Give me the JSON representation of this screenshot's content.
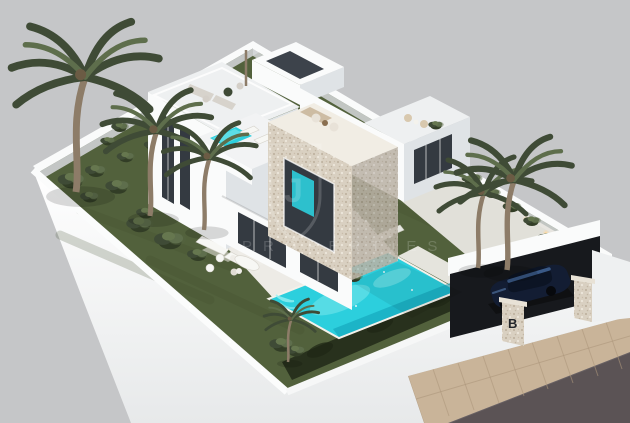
{
  "meta": {
    "image_type": "3D architectural rendering",
    "subject": "Aerial isometric view of a modern two-storey white villa with roof terraces, plunge pool, landscaped garden, turquoise swimming pool, palm trees and a carport with parked car on a floating walled plot",
    "background": "#c5c6c8"
  },
  "watermark": {
    "brand_text": "PROPERTIES",
    "monogram": "J"
  },
  "entrance": {
    "pillar_logo": "B"
  },
  "palette": {
    "bg": "#c5c6c8",
    "lawn": "#52613c",
    "lawnShade": "#3f4c2e",
    "hedge": "#28311d",
    "terrace": "#edebe6",
    "wallBright": "#fafbfb",
    "wallLight": "#eef0f1",
    "wallShade": "#dfe3e6",
    "glass": "#343a41",
    "stone": "#d9d0c1",
    "stoneDot": "#b3a591",
    "stoneTop": "#f1ede4",
    "pool": "#2ccfdd",
    "poolLight": "#96f0f3",
    "poolDeep": "#109fb4",
    "sidewalk": "#c9b499",
    "paver": "#ad977c",
    "road": "#5b5355",
    "carBody": "#131d33",
    "carGlass": "#3f6191",
    "furnGrey": "#d7d3cc",
    "furnWhite": "#f7f7f4",
    "trunk": "#8d7c68",
    "palm": "#3f4b36",
    "palmLight": "#5e6e4c",
    "lightWarm": "#ffd9a1",
    "watermark": "#ffffff"
  }
}
